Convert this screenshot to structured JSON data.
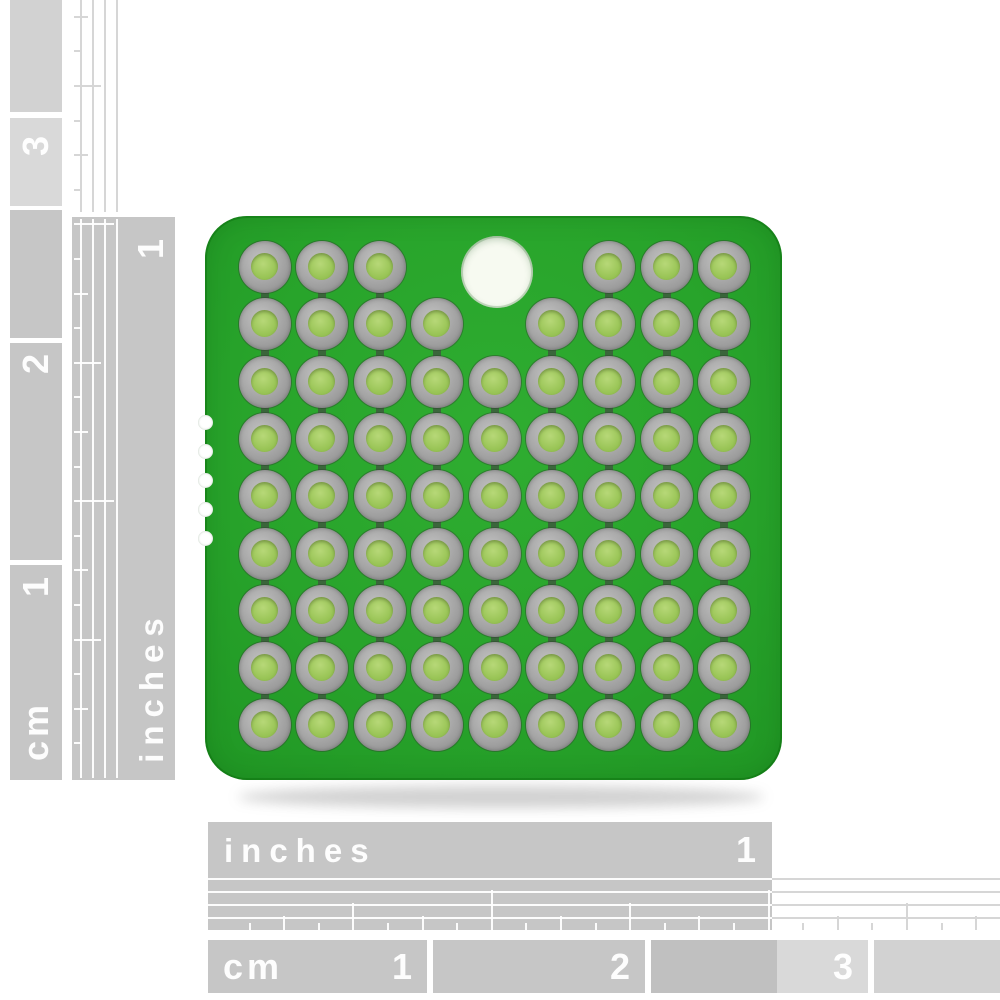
{
  "meta": {
    "description": "Product photo of a green square prototyping PCB with 9x9 plated hole grid, one large mounting hole, and cm/inch photo rulers on the left and bottom edges",
    "background_color": "#ffffff"
  },
  "rulers": {
    "text_color": "#ffffff",
    "block_color": "#c6c6c6",
    "block_color_light": "#d9d9d9",
    "line_color_on_white": "#d6d6d6",
    "left_cm": {
      "unit": "cm",
      "marks": [
        "3",
        "2",
        "1"
      ]
    },
    "left_inches": {
      "unit": "inches",
      "marks": [
        "1"
      ]
    },
    "bottom_inches": {
      "unit": "inches",
      "marks": [
        "1"
      ]
    },
    "bottom_cm": {
      "unit": "cm",
      "marks": [
        "1",
        "2",
        "3"
      ]
    }
  },
  "pcb": {
    "board_color": "#28a42b",
    "pad_ring_color": "#a8a8a8",
    "pad_hole_color": "#9ac557",
    "mounting_hole_color": "#f7faf1",
    "grid": {
      "rows": 9,
      "cols": 9,
      "missing_pads": [
        "1-4",
        "1-5",
        "1-6",
        "2-5"
      ],
      "edge_notches": 5
    }
  }
}
